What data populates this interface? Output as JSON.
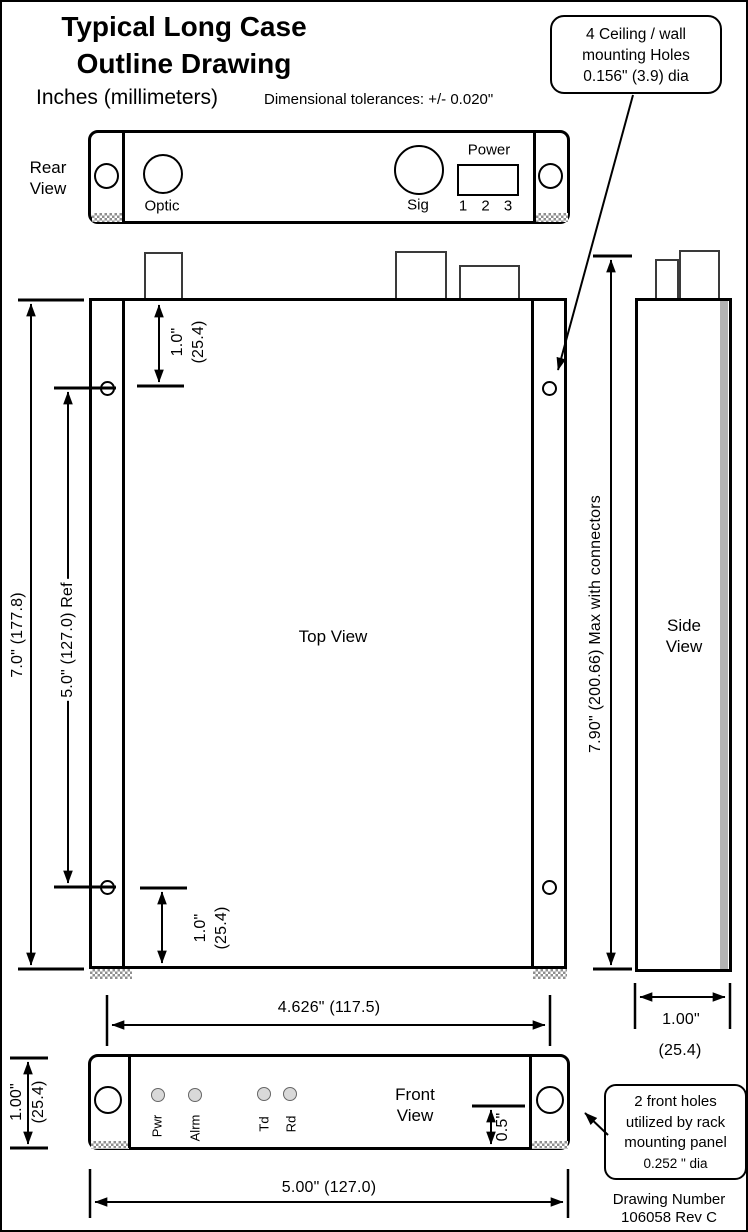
{
  "page": {
    "title_line1": "Typical Long Case",
    "title_line2": "Outline Drawing",
    "units_note": "Inches (millimeters)",
    "tolerance_note": "Dimensional tolerances: +/- 0.020\""
  },
  "callouts": {
    "ceiling_mounting": {
      "line1": "4 Ceiling / wall",
      "line2": "mounting Holes",
      "line3": "0.156\" (3.9) dia"
    },
    "front_holes": {
      "line1": "2 front holes",
      "line2": "utilized by rack",
      "line3": "mounting panel",
      "line4": "0.252 \" dia"
    }
  },
  "views": {
    "rear": {
      "label_line1": "Rear",
      "label_line2": "View",
      "optic_label": "Optic",
      "sig_label": "Sig",
      "power_label": "Power",
      "power_pins": "1 2 3"
    },
    "top": {
      "label": "Top View"
    },
    "side": {
      "label_line1": "Side",
      "label_line2": "View"
    },
    "front": {
      "label_line1": "Front",
      "label_line2": "View",
      "leds": [
        "Pwr",
        "Alrm",
        "Td",
        "Rd"
      ]
    }
  },
  "dimensions": {
    "overall_height": "7.0\" (177.8)",
    "hole_spacing_ref": "5.0\" (127.0) Ref",
    "top_hole_offset_in": "1.0\"",
    "top_hole_offset_mm": "(25.4)",
    "bottom_hole_offset_in": "1.0\"",
    "bottom_hole_offset_mm": "(25.4)",
    "max_height_with_connectors": "7.90\" (200.66) Max with connectors",
    "hole_span_width": "4.626\" (117.5)",
    "side_depth_in": "1.00\"",
    "side_depth_mm": "(25.4)",
    "front_height_in": "1.00\"",
    "front_height_mm": "(25.4)",
    "led_panel_offset": "0.5\"",
    "front_width": "5.00\" (127.0)"
  },
  "footer": {
    "line1": "Drawing Number",
    "line2": "106058 Rev C"
  },
  "colors": {
    "line": "#000000",
    "side_shade": "#b3b3b3",
    "led_fill": "#d9d9d9",
    "hatch": "#8f8f8f",
    "background": "#ffffff"
  }
}
